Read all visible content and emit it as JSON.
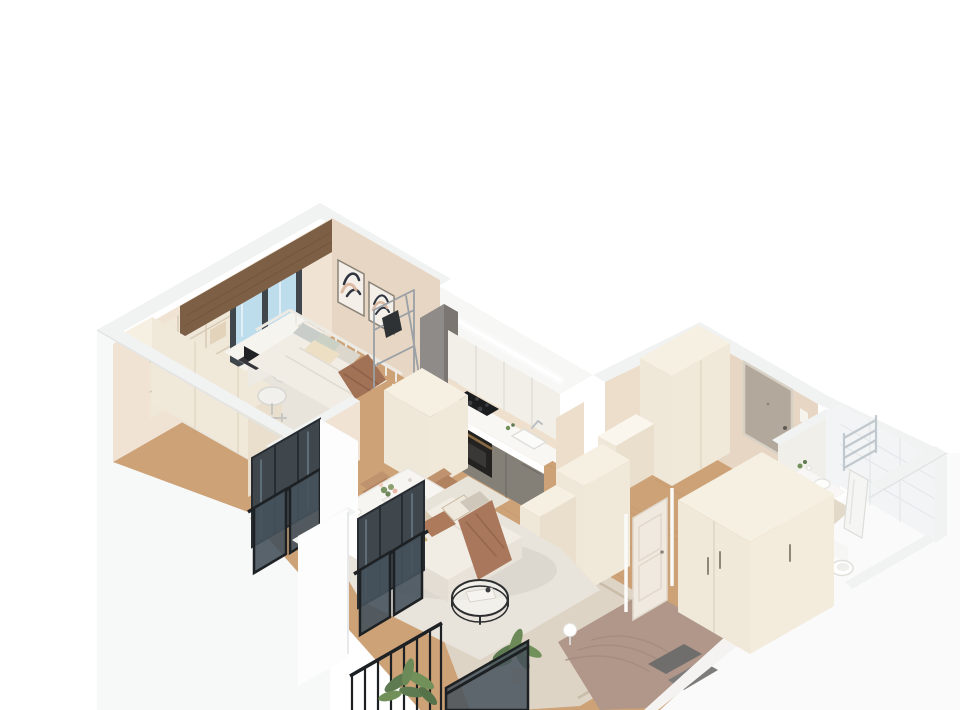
{
  "scene": {
    "title": "3D isometric cutaway floor plan render of a one-bedroom apartment, viewed from above on a white background",
    "type": "architectural 3D floor plan render",
    "rooms": [
      {
        "name": "bedroom-office",
        "items": [
          "window with wood valance",
          "cream L-shaped wardrobe",
          "open shelving unit",
          "white desk",
          "laptop",
          "white office chair",
          "white daybed with slat rail",
          "gray and sage pillows",
          "brown throw blanket",
          "two framed abstract artworks",
          "chrome clothes rack",
          "light area rug"
        ]
      },
      {
        "name": "kitchen",
        "items": [
          "tall gray cabinet column",
          "white upper cabinets",
          "LED-lit soffit",
          "gray base cabinets",
          "white countertop",
          "black induction cooktop",
          "oven with bronze handle",
          "sink",
          "cream end column"
        ]
      },
      {
        "name": "living-dining-room",
        "items": [
          "white dining table with flowers",
          "four tan chairs",
          "cream sofa with pillows",
          "terracotta throw",
          "round black wire coffee table",
          "cream area rug",
          "wood flooring",
          "potted palm plant"
        ]
      },
      {
        "name": "hallway",
        "items": [
          "entrance door",
          "intercom",
          "tall cream wardrobe",
          "low cabinet"
        ]
      },
      {
        "name": "bathroom",
        "items": [
          "white subway tile walls",
          "chrome towel ladder",
          "washing machine under counter",
          "small sink with flowers",
          "hanging towel",
          "toilet",
          "beige tile floor"
        ]
      },
      {
        "name": "second-bedroom",
        "items": [
          "bed with taupe bedding",
          "patterned gray pillows",
          "bordered area rug",
          "three-door cream wardrobe",
          "open panel door",
          "sphere floor lamp",
          "tall cream cabinets"
        ]
      },
      {
        "name": "balconies",
        "items": [
          "black French balcony railings with glass panels",
          "dark window glazing",
          "white wall piers",
          "corner balcony with black railing",
          "potted plants"
        ]
      }
    ]
  },
  "palette": {
    "bg": "#ffffff",
    "outerFace": "#fafafa",
    "outerFace2": "#f7f8f8",
    "wallBand": "#f1f2f2",
    "soffit": "#f7f7f6",
    "wallBeige": "#ecdecb",
    "wallBeigeDark": "#e7d6c3",
    "wallBeigeLight": "#f0e3d3",
    "backsplash": "#eee0cd",
    "tile": "#f2f4f5",
    "tileLine": "#e2e6e8",
    "floorWood": "#cda277",
    "floorWoodLine": "#b98f66",
    "bathFloor": "#e3d9c8",
    "rugLight": "#e9e4db",
    "rugBed2": "#ded4c5",
    "rugBorder": "#c9bda9",
    "cream": "#efe7d8",
    "creamFace": "#f0e8d8",
    "creamLight": "#f6f0e3",
    "creamDark": "#e9dfcc",
    "grayCab": "#8f8b88",
    "grayCabDark": "#7b7672",
    "grayCabTop": "#a5a29f",
    "baseCab": "#848078",
    "counter": "#f8f7f4",
    "cooktop": "#1b1c1e",
    "oven": "#232221",
    "bronze": "#8a6a42",
    "glassBlue": "#bddcec",
    "windowFrame": "#3f464c",
    "railGlass": "#46525c",
    "railFrame": "#1d2124",
    "valance": "#7d5f46",
    "artDark": "#2e3440",
    "artBlush": "#d9b49c",
    "duvet1": "#f1ece4",
    "pillowSage": "#ccd1c5",
    "throwBrown": "#a9785c",
    "sofa": "#ece7de",
    "sofaBack": "#e8e3d9",
    "sofaSeat": "#f2ede4",
    "sofaFront": "#e3ddd3",
    "pillowGold": "#c9ad72",
    "pillowBeige": "#d8cbb6",
    "pillowBrown": "#ad7a5c",
    "chairTan": "#c0936f",
    "chairTanDark": "#b08260",
    "tableWhite": "#f7f5f1",
    "bedTaupe": "#b09789",
    "pillowGray": "#6f6e6c",
    "doorEntry": "#b3a89c",
    "doorCream": "#efe9e0",
    "chrome": "#c2c9ce",
    "washerDrum": "#2e2c2a",
    "plant": "#5d7a50",
    "plantLight": "#72915a",
    "white": "#ffffff",
    "offWhite": "#fdfdfd"
  }
}
